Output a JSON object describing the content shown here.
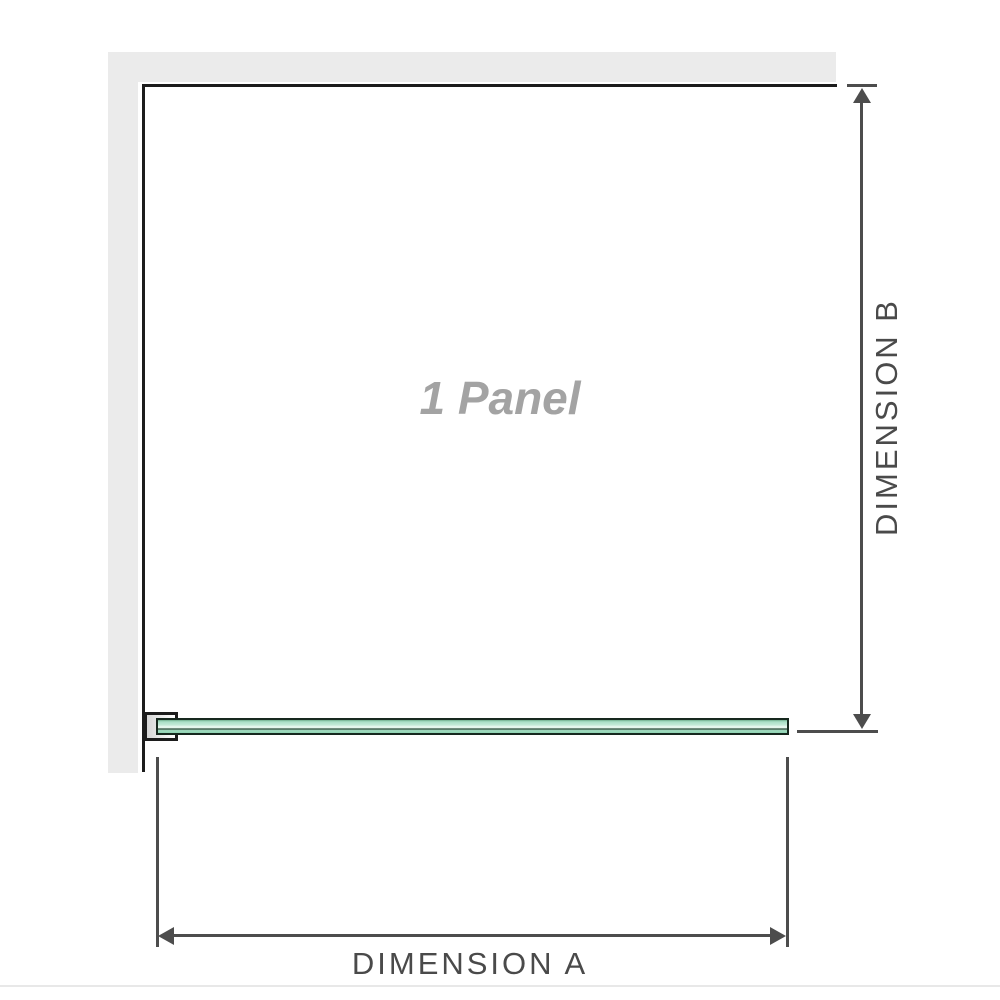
{
  "diagram": {
    "panel_label": "1 Panel",
    "dimension_a_label": "DIMENSION A",
    "dimension_b_label": "DIMENSION B"
  },
  "colors": {
    "wall-fill": "#ebebeb",
    "wall-line": "#1c1c1c",
    "dim-line": "#4d4d4d",
    "label-text": "#4a4a4a",
    "panel-text": "#a3a3a3",
    "glass-border": "#16281e",
    "edge-line": "#e8e8e8"
  }
}
